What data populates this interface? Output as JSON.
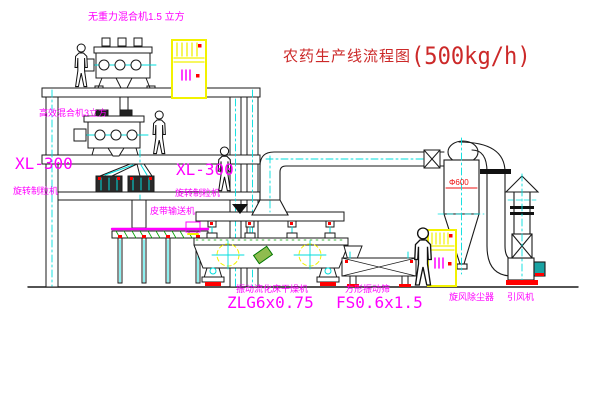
{
  "title": {
    "text_zh": "农药生产线流程图",
    "capacity": "(500kg/h)"
  },
  "equipment_labels": {
    "gravity_free_mixer": "无重力混合机1.5 立方",
    "high_efficiency_mixer": "高效混合机3立方",
    "granulator_left_model": "XL-300",
    "granulator_left_name": "旋转制粒机",
    "granulator_mid_model": "XL-300",
    "granulator_mid_name": "旋转制粒机",
    "belt_conveyor": "皮带输送机",
    "fluid_bed_dryer_name": "振动流化床干燥机",
    "fluid_bed_dryer_model": "ZLG6x0.75",
    "square_sieve_name": "方形振动筛",
    "square_sieve_model": "FS0.6x1.5",
    "cyclone_collector": "旋风除尘器",
    "induced_draft_fan": "引风机",
    "cyclone_diameter": "Φ600"
  },
  "colors": {
    "label_magenta": "#ff00ff",
    "title_red": "#cc2929",
    "line_black": "#1a1a1a",
    "accent_cyan": "#00dede",
    "accent_yellow": "#f2f200",
    "accent_red": "#ff0000",
    "accent_green": "#00a000"
  }
}
